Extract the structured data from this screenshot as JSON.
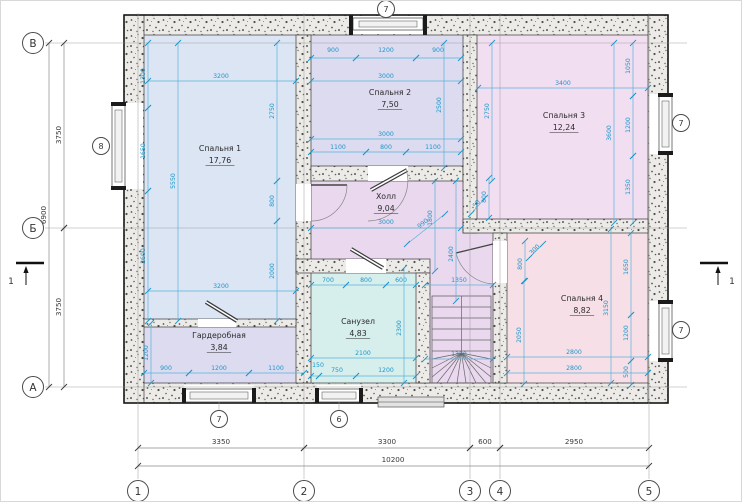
{
  "plan": {
    "rooms": [
      {
        "id": "bedroom-1",
        "name": "Спальня 1",
        "area": "17,76",
        "fill": "#dbe5f3",
        "x": 219,
        "y": 150
      },
      {
        "id": "bedroom-2",
        "name": "Спальня 2",
        "area": "7,50",
        "fill": "#dcdbf0",
        "x": 389,
        "y": 94
      },
      {
        "id": "bedroom-3",
        "name": "Спальня 3",
        "area": "12,24",
        "fill": "#f2def1",
        "x": 563,
        "y": 117
      },
      {
        "id": "bedroom-4",
        "name": "Спальня 4",
        "area": "8,82",
        "fill": "#f6dfe7",
        "x": 581,
        "y": 300
      },
      {
        "id": "hall",
        "name": "Холл",
        "area": "9,04",
        "fill": "#e9d8ee",
        "x": 385,
        "y": 198
      },
      {
        "id": "bathroom",
        "name": "Санузел",
        "area": "4,83",
        "fill": "#d6efed",
        "x": 357,
        "y": 323
      },
      {
        "id": "wardrobe",
        "name": "Гардеробная",
        "area": "3,84",
        "fill": "#dcdbf0",
        "x": 218,
        "y": 337
      }
    ],
    "axes_left": [
      {
        "label": "В",
        "x": 32,
        "y": 42
      },
      {
        "label": "Б",
        "x": 32,
        "y": 227
      },
      {
        "label": "А",
        "x": 32,
        "y": 386
      }
    ],
    "axes_bottom": [
      {
        "label": "1",
        "x": 137,
        "y": 490
      },
      {
        "label": "2",
        "x": 303,
        "y": 490
      },
      {
        "label": "3",
        "x": 469,
        "y": 490
      },
      {
        "label": "4",
        "x": 499,
        "y": 490
      },
      {
        "label": "5",
        "x": 648,
        "y": 490
      }
    ],
    "window_markers": [
      {
        "label": "7",
        "x": 385,
        "y": 8
      },
      {
        "label": "8",
        "x": 100,
        "y": 145
      },
      {
        "label": "7",
        "x": 680,
        "y": 122
      },
      {
        "label": "7",
        "x": 680,
        "y": 329
      },
      {
        "label": "7",
        "x": 218,
        "y": 418
      },
      {
        "label": "6",
        "x": 338,
        "y": 418
      }
    ],
    "section_markers": [
      {
        "label": "1",
        "x": 29,
        "y": 262,
        "arrow_x": 25,
        "label_x": 10
      },
      {
        "label": "1",
        "x": 713,
        "y": 262,
        "arrow_x": 717,
        "label_x": 731
      }
    ],
    "dims_dark": [
      {
        "v": "3750",
        "t": [
          60,
          134
        ],
        "r": -90,
        "l": [
          63,
          42,
          63,
          227
        ]
      },
      {
        "v": "3750",
        "t": [
          60,
          306
        ],
        "r": -90,
        "l": [
          63,
          227,
          63,
          386
        ]
      },
      {
        "v": "6900",
        "t": [
          45,
          214
        ],
        "r": -90,
        "l": [
          48,
          42,
          48,
          386
        ]
      },
      {
        "v": "3350",
        "t": [
          220,
          443
        ],
        "r": 0,
        "l": [
          137,
          447,
          303,
          447
        ]
      },
      {
        "v": "3300",
        "t": [
          386,
          443
        ],
        "r": 0,
        "l": [
          303,
          447,
          469,
          447
        ]
      },
      {
        "v": "600",
        "t": [
          484,
          443
        ],
        "r": 0,
        "l": [
          469,
          447,
          499,
          447
        ]
      },
      {
        "v": "2950",
        "t": [
          573,
          443
        ],
        "r": 0,
        "l": [
          499,
          447,
          648,
          447
        ]
      },
      {
        "v": "10200",
        "t": [
          392,
          461
        ],
        "r": 0,
        "l": [
          137,
          465,
          648,
          465
        ]
      }
    ],
    "dims_cyan": [
      {
        "v": "1300",
        "t": [
          144,
          75
        ],
        "r": -90,
        "l": [
          147,
          42,
          147,
          107
        ]
      },
      {
        "v": "1650",
        "t": [
          144,
          150
        ],
        "r": -90,
        "l": [
          147,
          107,
          147,
          190
        ]
      },
      {
        "v": "2600",
        "t": [
          144,
          255
        ],
        "r": -90,
        "l": [
          147,
          190,
          147,
          320
        ]
      },
      {
        "v": "3200",
        "t": [
          220,
          77
        ],
        "r": 0,
        "l": [
          147,
          80,
          295,
          80
        ]
      },
      {
        "v": "5550",
        "t": [
          174,
          180
        ],
        "r": -90,
        "l": [
          177,
          42,
          177,
          320
        ]
      },
      {
        "v": "2750",
        "t": [
          273,
          110
        ],
        "r": -90,
        "l": [
          276,
          42,
          276,
          180
        ]
      },
      {
        "v": "800",
        "t": [
          273,
          200
        ],
        "r": -90,
        "l": [
          276,
          180,
          276,
          220
        ]
      },
      {
        "v": "2000",
        "t": [
          273,
          270
        ],
        "r": -90,
        "l": [
          276,
          220,
          276,
          320
        ]
      },
      {
        "v": "3200",
        "t": [
          220,
          287
        ],
        "r": 0,
        "l": [
          147,
          290,
          295,
          290
        ]
      },
      {
        "v": "1200",
        "t": [
          147,
          352
        ],
        "r": -90,
        "l": [
          150,
          322,
          150,
          382
        ]
      },
      {
        "v": "900",
        "t": [
          165,
          369
        ],
        "r": 0,
        "l": [
          143,
          372,
          188,
          372
        ]
      },
      {
        "v": "1200",
        "t": [
          218,
          369
        ],
        "r": 0,
        "l": [
          188,
          372,
          248,
          372
        ]
      },
      {
        "v": "1100",
        "t": [
          275,
          369
        ],
        "r": 0,
        "l": [
          248,
          372,
          303,
          372
        ]
      },
      {
        "v": "900",
        "t": [
          332,
          51
        ],
        "r": 0,
        "l": [
          310,
          57,
          355,
          57
        ]
      },
      {
        "v": "1200",
        "t": [
          385,
          51
        ],
        "r": 0,
        "l": [
          355,
          57,
          415,
          57
        ]
      },
      {
        "v": "900",
        "t": [
          437,
          51
        ],
        "r": 0,
        "l": [
          415,
          57,
          460,
          57
        ]
      },
      {
        "v": "3000",
        "t": [
          385,
          77
        ],
        "r": 0,
        "l": [
          310,
          80,
          460,
          80
        ]
      },
      {
        "v": "2500",
        "t": [
          440,
          104
        ],
        "r": -90,
        "l": [
          443,
          42,
          443,
          167
        ]
      },
      {
        "v": "3000",
        "t": [
          385,
          135
        ],
        "r": 0,
        "l": [
          310,
          138,
          460,
          138
        ]
      },
      {
        "v": "1100",
        "t": [
          337,
          148
        ],
        "r": 0,
        "l": [
          310,
          151,
          365,
          151
        ]
      },
      {
        "v": "800",
        "t": [
          385,
          148
        ],
        "r": 0,
        "l": [
          365,
          151,
          405,
          151
        ]
      },
      {
        "v": "1100",
        "t": [
          432,
          148
        ],
        "r": 0,
        "l": [
          405,
          151,
          460,
          151
        ]
      },
      {
        "v": "2750",
        "t": [
          488,
          110
        ],
        "r": -90,
        "l": [
          491,
          42,
          491,
          180
        ]
      },
      {
        "v": "3400",
        "t": [
          562,
          84
        ],
        "r": 0,
        "l": [
          477,
          87,
          647,
          87
        ]
      },
      {
        "v": "1050",
        "t": [
          629,
          65
        ],
        "r": -90,
        "l": [
          632,
          42,
          632,
          95
        ]
      },
      {
        "v": "1200",
        "t": [
          629,
          124
        ],
        "r": -90,
        "l": [
          632,
          95,
          632,
          155
        ]
      },
      {
        "v": "1350",
        "t": [
          629,
          186
        ],
        "r": -90,
        "l": [
          632,
          155,
          632,
          222
        ]
      },
      {
        "v": "3600",
        "t": [
          610,
          132
        ],
        "r": -90,
        "l": [
          613,
          42,
          613,
          222
        ]
      },
      {
        "v": "3000",
        "t": [
          385,
          223
        ],
        "r": 0,
        "l": [
          310,
          227,
          460,
          227
        ]
      },
      {
        "v": "1800",
        "t": [
          431,
          217
        ],
        "r": -90,
        "l": [
          434,
          180,
          434,
          270
        ]
      },
      {
        "v": "990",
        "t": [
          423,
          224
        ],
        "r": -38,
        "l": [
          406,
          243,
          444,
          213
        ]
      },
      {
        "v": "50",
        "t": [
          477,
          204
        ],
        "r": -50,
        "l": [
          470,
          213,
          484,
          197
        ]
      },
      {
        "v": "2400",
        "t": [
          452,
          253
        ],
        "r": -90,
        "l": [
          455,
          180,
          455,
          300
        ]
      },
      {
        "v": "800",
        "t": [
          485,
          196
        ],
        "r": -90,
        "l": [
          488,
          177,
          488,
          217
        ]
      },
      {
        "v": "700",
        "t": [
          327,
          281
        ],
        "r": 0,
        "l": [
          310,
          284,
          345,
          284
        ]
      },
      {
        "v": "800",
        "t": [
          365,
          281
        ],
        "r": 0,
        "l": [
          345,
          284,
          385,
          284
        ]
      },
      {
        "v": "600",
        "t": [
          400,
          281
        ],
        "r": 0,
        "l": [
          385,
          284,
          415,
          284
        ]
      },
      {
        "v": "2300",
        "t": [
          400,
          327
        ],
        "r": -90,
        "l": [
          403,
          267,
          403,
          382
        ]
      },
      {
        "v": "2100",
        "t": [
          362,
          354
        ],
        "r": 0,
        "l": [
          310,
          357,
          415,
          357
        ]
      },
      {
        "v": "150",
        "t": [
          317,
          366
        ],
        "r": 0,
        "l": [
          310,
          375,
          318,
          375
        ]
      },
      {
        "v": "750",
        "t": [
          336,
          371
        ],
        "r": 0,
        "l": [
          318,
          375,
          355,
          375
        ]
      },
      {
        "v": "1200",
        "t": [
          385,
          371
        ],
        "r": 0,
        "l": [
          355,
          375,
          415,
          375
        ]
      },
      {
        "v": "1350",
        "t": [
          458,
          281
        ],
        "r": 0,
        "l": [
          424,
          284,
          492,
          284
        ]
      },
      {
        "v": "1350",
        "t": [
          458,
          355
        ],
        "r": 0,
        "l": [
          424,
          358,
          492,
          358
        ]
      },
      {
        "v": "300",
        "t": [
          535,
          250
        ],
        "r": -45,
        "l": [
          528,
          257,
          542,
          243
        ]
      },
      {
        "v": "800",
        "t": [
          521,
          263
        ],
        "r": -90,
        "l": [
          524,
          240,
          524,
          280
        ]
      },
      {
        "v": "2050",
        "t": [
          520,
          334
        ],
        "r": -90,
        "l": [
          523,
          280,
          523,
          383
        ]
      },
      {
        "v": "3150",
        "t": [
          607,
          307
        ],
        "r": -90,
        "l": [
          610,
          228,
          610,
          382
        ]
      },
      {
        "v": "1650",
        "t": [
          627,
          266
        ],
        "r": -90,
        "l": [
          630,
          232,
          630,
          314
        ]
      },
      {
        "v": "1200",
        "t": [
          627,
          332
        ],
        "r": -90,
        "l": [
          630,
          314,
          630,
          360
        ]
      },
      {
        "v": "500",
        "t": [
          627,
          371
        ],
        "r": -90,
        "l": [
          630,
          360,
          630,
          384
        ]
      },
      {
        "v": "2800",
        "t": [
          573,
          353
        ],
        "r": 0,
        "l": [
          506,
          356,
          647,
          356
        ]
      },
      {
        "v": "2800",
        "t": [
          573,
          369
        ],
        "r": 0,
        "l": [
          506,
          372,
          647,
          372
        ]
      }
    ],
    "colors": {
      "dim_text": "#1f96c8",
      "dim_line": "#5ab2d8",
      "dark_text": "#3a3a3a",
      "dark_line": "#8a8a8a",
      "label_text": "#2b2b2b"
    }
  }
}
